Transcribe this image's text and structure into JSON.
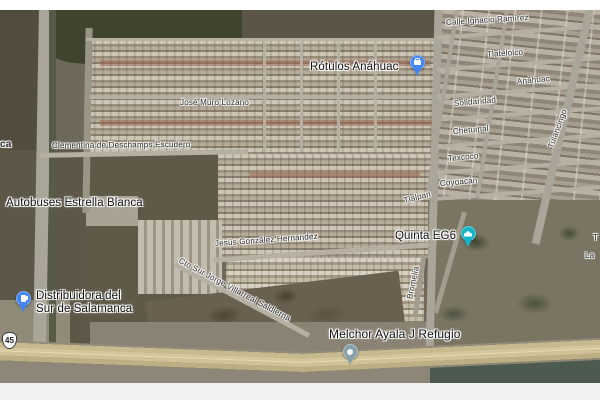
{
  "map": {
    "street_labels": [
      {
        "text": "Calle Ignacio Ramírez"
      },
      {
        "text": "Tlatelolco"
      },
      {
        "text": "Anáhuac"
      },
      {
        "text": "Solidaridad"
      },
      {
        "text": "Chetumal"
      },
      {
        "text": "Texcoco"
      },
      {
        "text": "Coyoacán"
      },
      {
        "text": "Tlalpan"
      },
      {
        "text": "Tulancingo"
      },
      {
        "text": "Bromelia"
      },
      {
        "text": "José Muro Lozano"
      },
      {
        "text": "Clementina de Deschamps Escudero"
      },
      {
        "text": "Jesús González Hernández"
      },
      {
        "text": "Cto Sur Jorge Villarreal Saldierna"
      }
    ],
    "poi_labels": {
      "rotulos": {
        "text": "Rótulos Anáhuac"
      },
      "autobuses": {
        "text": "Autobuses Estrella Blanca"
      },
      "distribuidora": {
        "line1": "Distribuidora del",
        "line2": "Sur de Salamanca"
      },
      "quinta": {
        "text": "Quinta EG6"
      },
      "melchor": {
        "text": "Melchor Ayala J Refugio"
      }
    },
    "partial_labels": [
      {
        "text": "ca"
      },
      {
        "text": "T"
      },
      {
        "text": "La"
      }
    ],
    "markers": [
      {
        "name": "Rótulos Anáhuac",
        "type": "business",
        "color": "#4285f4"
      },
      {
        "name": "Quinta EG6",
        "type": "event-venue",
        "color": "#14b5c7"
      },
      {
        "name": "Distribuidora del Sur de Salamanca",
        "type": "gas-station",
        "color": "#4285f4"
      },
      {
        "name": "Melchor Ayala J Refugio",
        "type": "place",
        "color": "#87a1a9"
      }
    ],
    "highway_shield": {
      "number": "45"
    },
    "colors": {
      "marker_blue": "#4285f4",
      "marker_teal": "#14b5c7",
      "marker_gray": "#87a1a9",
      "label_text": "#2e2d2b",
      "label_halo": "#ffffff"
    }
  }
}
